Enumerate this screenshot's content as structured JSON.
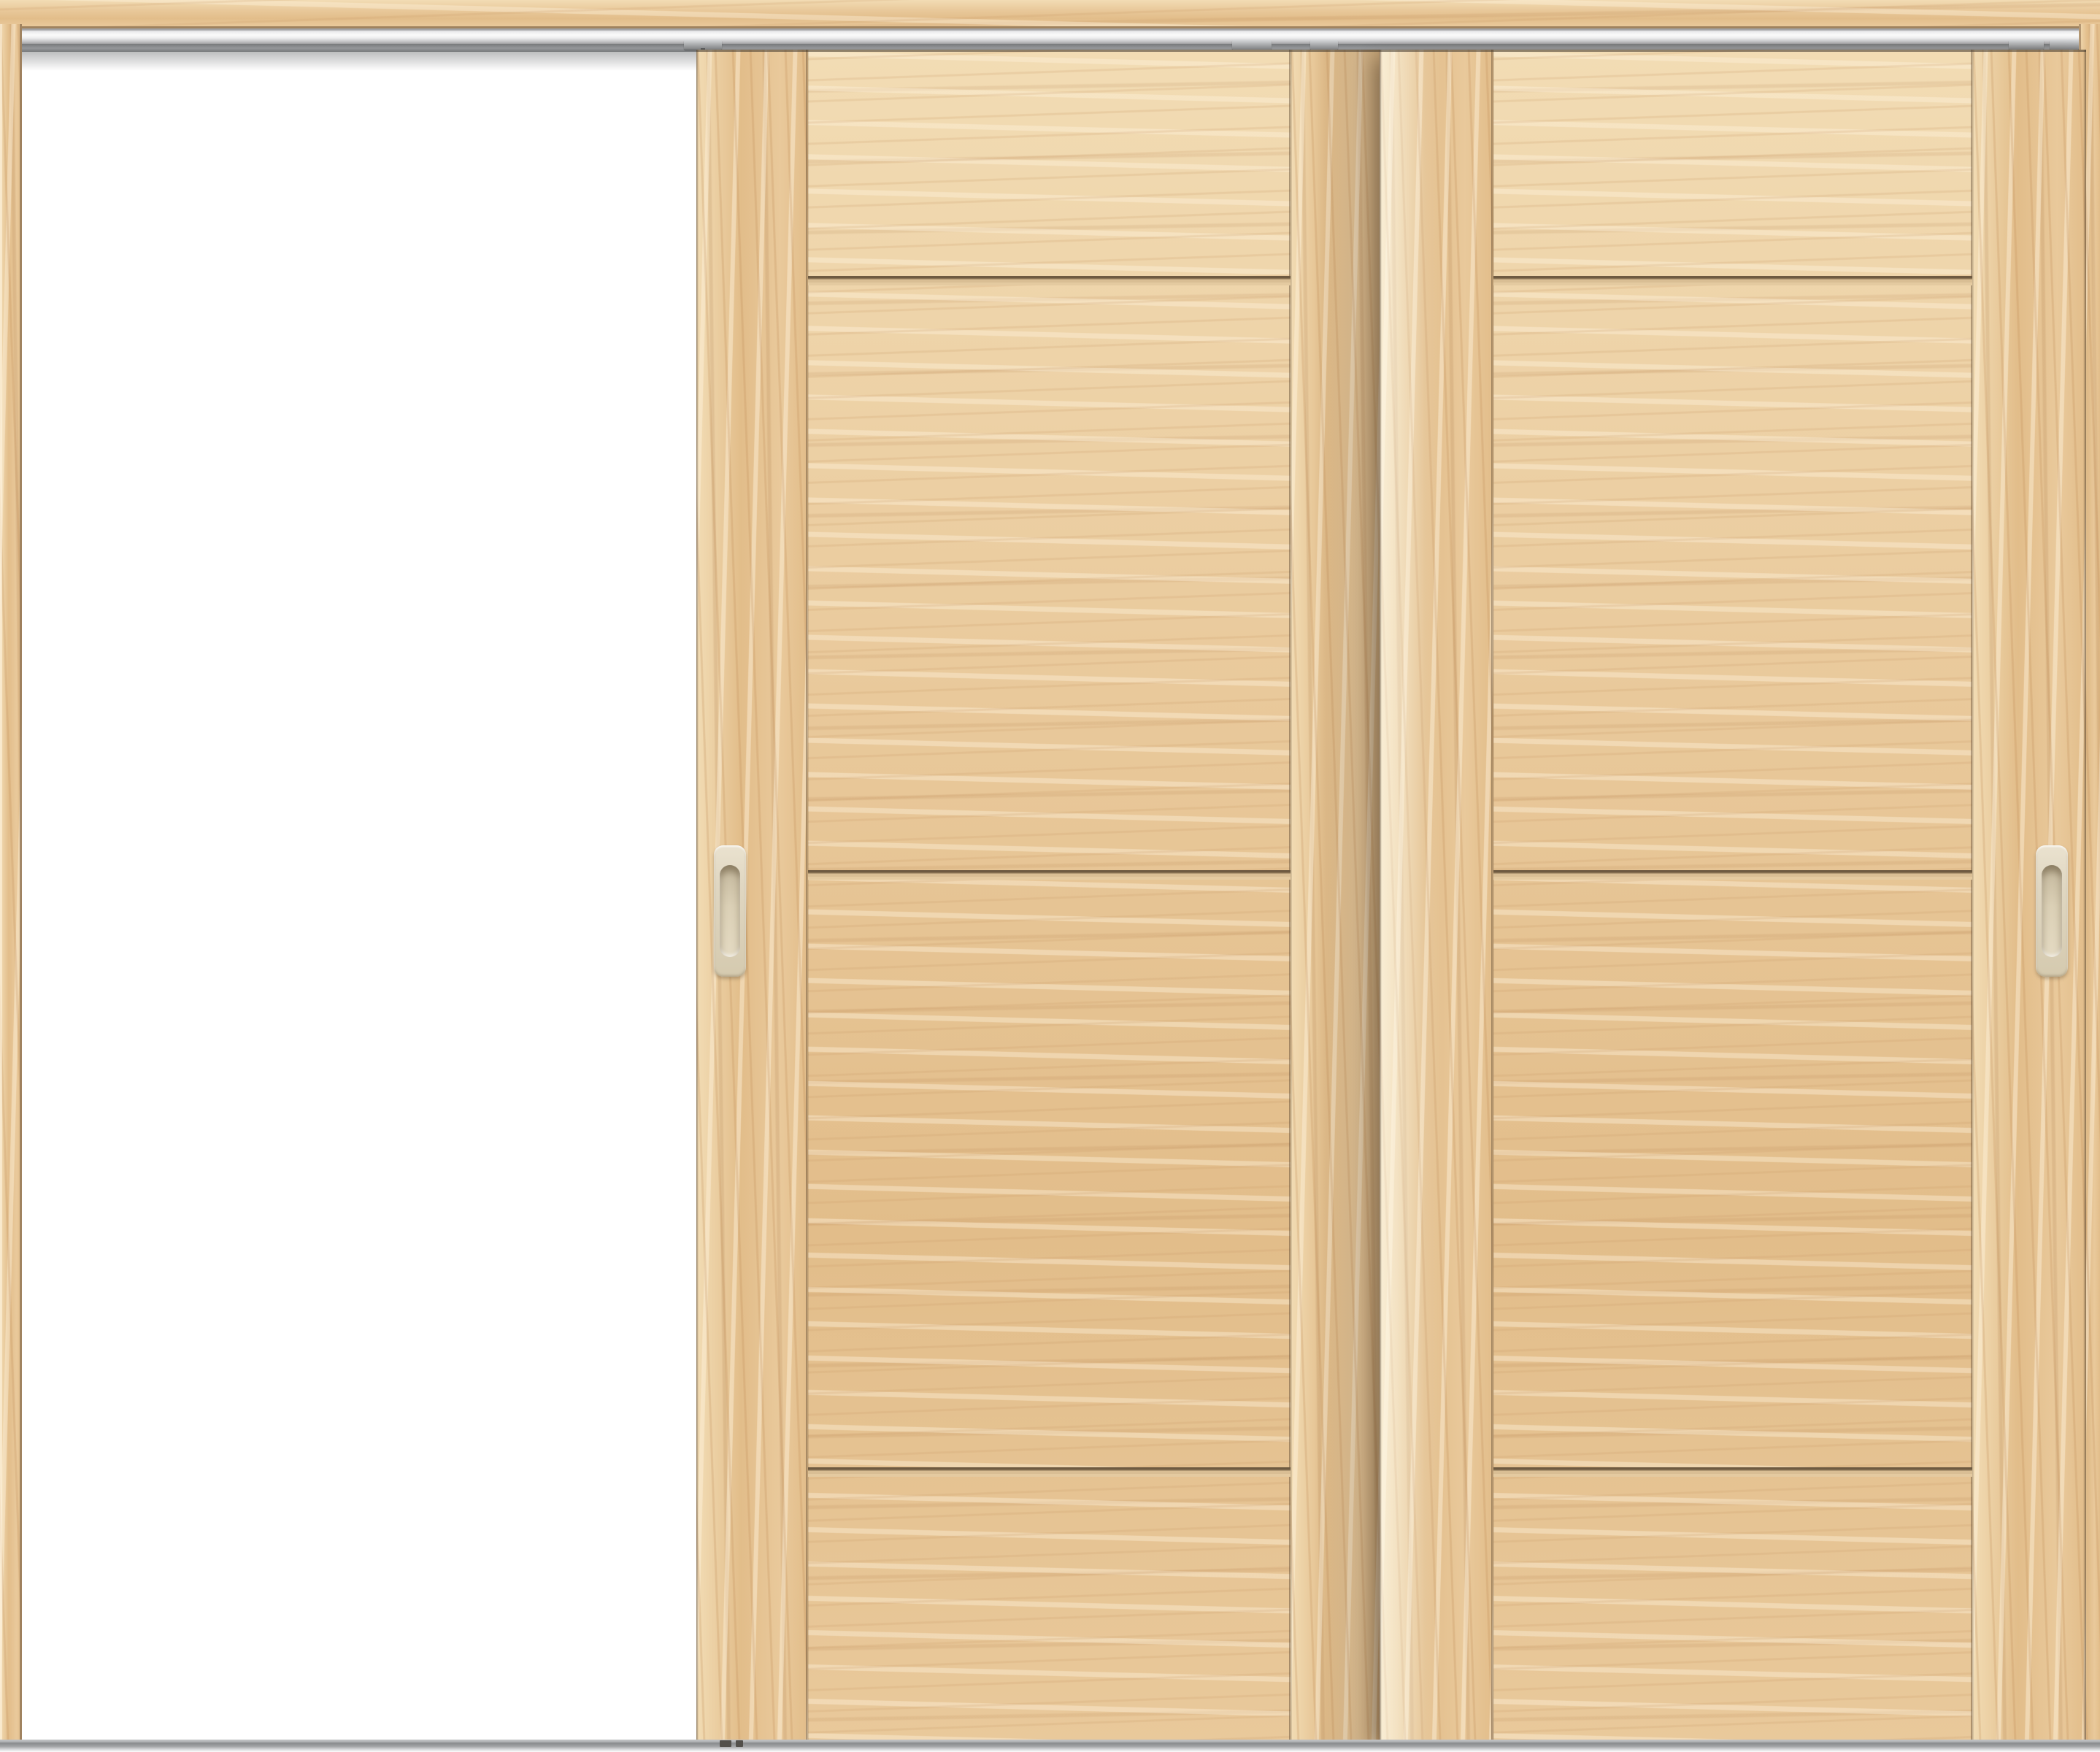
{
  "scene": {
    "type": "product-photo",
    "subject": "two-panel wooden sliding interior door unit, maple finish",
    "state": "left leaf slid open revealing empty white opening",
    "visible_text": [],
    "parts": {
      "header_beam": "wood lintel across the top",
      "top_track": "aluminum hanging track under the lintel",
      "hanger_rail": "dark grey hanger channel with roller clips",
      "frame_left": "left vertical jamb",
      "frame_right": "right vertical jamb (mostly hidden behind right door)",
      "door_left": "rear sliding leaf with vertical-grain stiles and 4 horizontal-grain panels",
      "door_right": "front sliding leaf with vertical-grain stiles and 4 horizontal-grain panels",
      "grooves": "three horizontal shadow grooves dividing each leaf into four panels",
      "handle_left": "recessed oval pull on left stile of rear leaf",
      "handle_right": "recessed oval pull on right stile of front leaf",
      "floor_rail": "grey floor guide rail across the bottom",
      "guide_feet": "small dark floor guides under the rear leaf"
    }
  },
  "palette": {
    "white": "#ffffff",
    "wood-light": "#f2dcb4",
    "wood-base": "#e9c99b",
    "wood-mid": "#e2bd8a",
    "beam-edge": "#a0835f",
    "silver-hi": "#fafafa",
    "silver-lo": "#a4a4a6",
    "rail-dark": "#77797b",
    "floor-rail": "#8a8c8e",
    "handle-body": "#e0d7c2",
    "handle-recess": "#c3b79c"
  }
}
